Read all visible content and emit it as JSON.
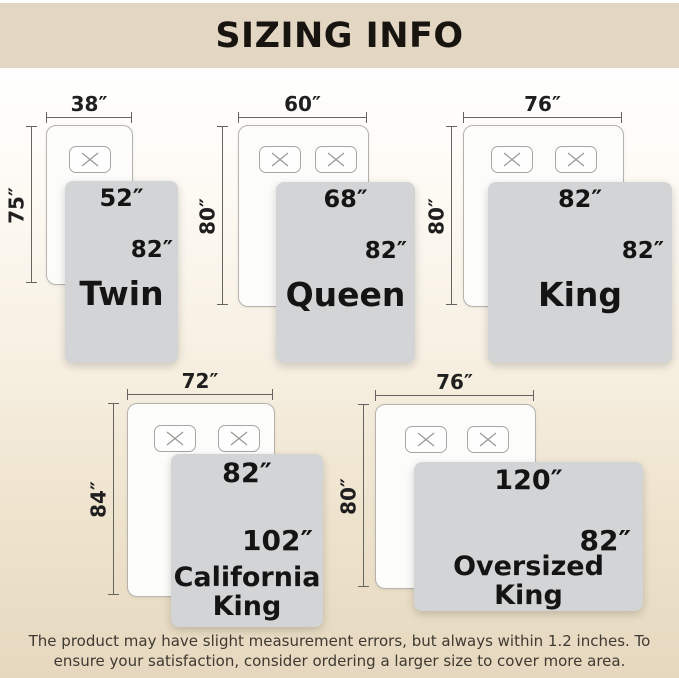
{
  "header": {
    "title": "SIZING INFO"
  },
  "colors": {
    "header_band": "#e3d7c3",
    "background_bottom": "#e6d8bf",
    "blanket": "#d3d4d5",
    "measure_line": "#666460",
    "text": "#141414"
  },
  "diagrams": [
    {
      "name": "Twin",
      "mattress_width": "38″",
      "mattress_length": "75″",
      "blanket_width": "52″",
      "blanket_length": "82″",
      "pillows": 1
    },
    {
      "name": "Queen",
      "mattress_width": "60″",
      "mattress_length": "80″",
      "blanket_width": "68″",
      "blanket_length": "82″",
      "pillows": 2
    },
    {
      "name": "King",
      "mattress_width": "76″",
      "mattress_length": "80″",
      "blanket_width": "82″",
      "blanket_length": "82″",
      "pillows": 2
    },
    {
      "name": "California\nKing",
      "mattress_width": "72″",
      "mattress_length": "84″",
      "blanket_width": "82″",
      "blanket_length": "102″",
      "pillows": 2
    },
    {
      "name": "Oversized\nKing",
      "mattress_width": "76″",
      "mattress_length": "80″",
      "blanket_width": "120″",
      "blanket_length": "82″",
      "pillows": 2
    }
  ],
  "footer": {
    "note": "The product may have slight measurement errors, but always within 1.2 inches. To ensure your satisfaction, consider ordering a larger size to cover more area."
  }
}
